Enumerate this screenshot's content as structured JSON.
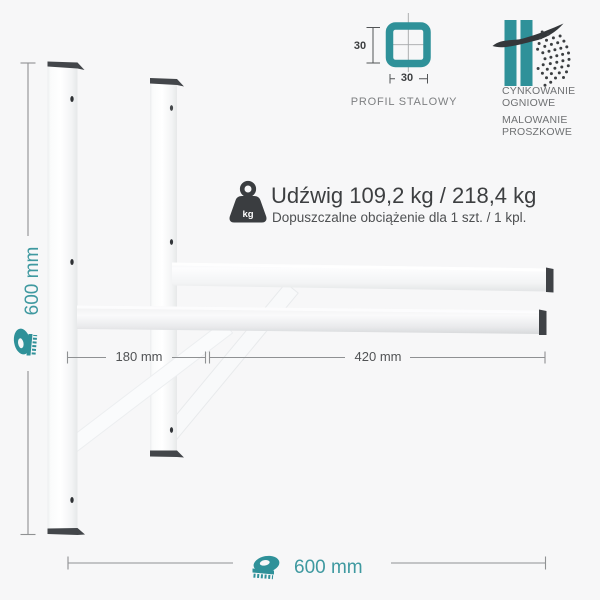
{
  "scene": {
    "background": "#f7f7f8"
  },
  "badges": {
    "profile": {
      "label": "PROFIL STALOWY",
      "side_size": "30",
      "bottom_size": "30"
    },
    "coating": {
      "line1": "CYNKOWANIE",
      "line2": "OGNIOWE",
      "line3": "MALOWANIE",
      "line4": "PROSZKOWE"
    }
  },
  "capacity": {
    "icon_label": "kg",
    "title": "Udźwig 109,2 kg / 218,4 kg",
    "subtitle": "Dopuszczalne obciążenie dla 1 szt. / 1 kpl."
  },
  "dimensions": {
    "height_label": "600 mm",
    "width_label": "600 mm",
    "segment_back_label": "180 mm",
    "segment_front_label": "420 mm"
  },
  "colors": {
    "teal_icon": "#2f9199",
    "teal_text": "#3f99a0",
    "end_cap_dark": "#43464a",
    "dimension_line_gray": "#8f9193",
    "text_dark": "#3d3f41"
  }
}
